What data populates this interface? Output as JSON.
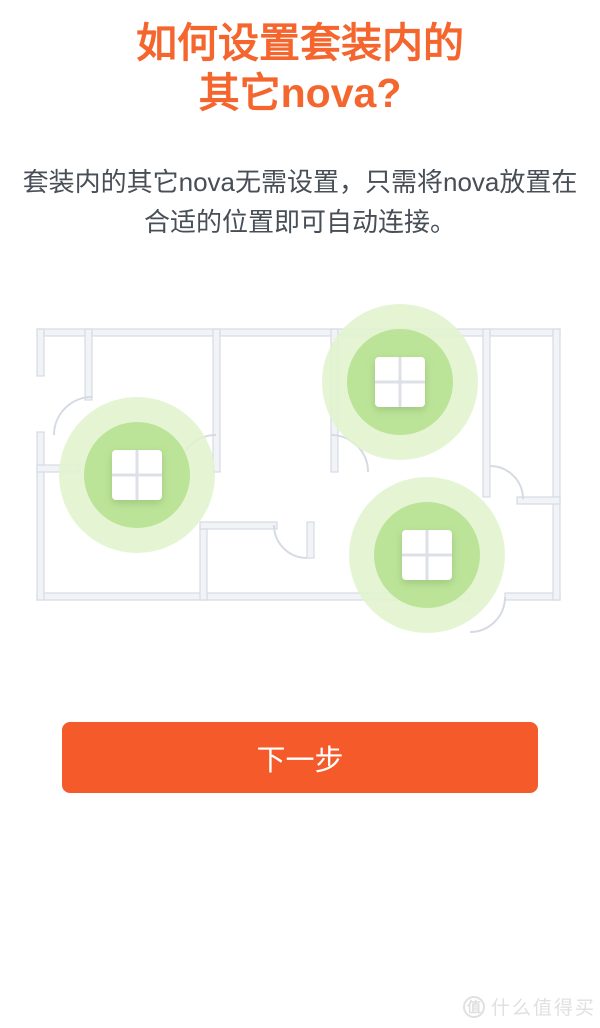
{
  "header": {
    "title_line1": "如何设置套装内的",
    "title_line2": "其它nova?"
  },
  "body": {
    "description": "套装内的其它nova无需设置，只需将nova放置在合适的位置即可自动连接。"
  },
  "footer": {
    "next_button_label": "下一步"
  },
  "watermark": {
    "logo_char": "值",
    "text": "什么值得买"
  },
  "colors": {
    "title_orange": "#f4662e",
    "button_orange": "#f55a2b",
    "body_text": "#474e56",
    "wall_fill": "#f1f3f7",
    "wall_stroke": "#d6dbe3",
    "glow_outer": "#e0f3cd",
    "glow_inner": "#b7e292",
    "device_fill": "#ffffff",
    "device_grid": "#dde1e7",
    "watermark_gray": "#e0e0e0"
  },
  "floorplan": {
    "caption": "floor plan showing three nova units auto-connecting",
    "device_size": 50,
    "glow_outer_radius": 78,
    "glow_inner_radius": 53,
    "devices": [
      {
        "id": "nova-left",
        "x": 137,
        "y": 173
      },
      {
        "id": "nova-top-right",
        "x": 400,
        "y": 80
      },
      {
        "id": "nova-bottom-right",
        "x": 427,
        "y": 253
      }
    ]
  }
}
